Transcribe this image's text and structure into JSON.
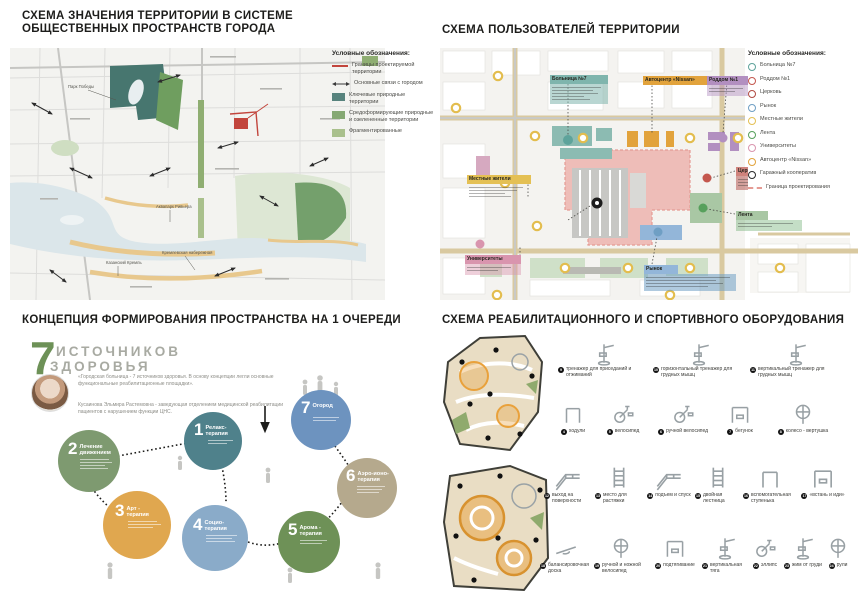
{
  "q1": {
    "title_line1": "СХЕМА ЗНАЧЕНИЯ ТЕРРИТОРИИ В СИСТЕМЕ",
    "title_line2": "ОБЩЕСТВЕННЫХ ПРОСТРАНСТВ ГОРОДА",
    "legend": {
      "title": "Условные обозначения:",
      "items": [
        {
          "label": "Границы проектируемой территории",
          "swatch": "red-line",
          "color": "#c2453c"
        },
        {
          "label": "Основные связи с городом",
          "swatch": "double-arrow",
          "color": "#3a3a3a"
        },
        {
          "label": "Ключевые природные территории",
          "swatch": "square",
          "color": "#57837d"
        },
        {
          "label": "Средоформирующие природные и озелененные территории",
          "swatch": "square",
          "color": "#85a873"
        },
        {
          "label": "Фрагментированные",
          "swatch": "square",
          "color": "#a9c08c"
        }
      ]
    },
    "map_labels": [
      "Парк Победы",
      "Аквапарк Ривьера",
      "Кремлевская набережная",
      "Казанский Кремль"
    ]
  },
  "q2": {
    "title": "СХЕМА ПОЛЬЗОВАТЕЛЕЙ ТЕРРИТОРИИ",
    "legend": {
      "title": "Условные обозначения:",
      "items": [
        {
          "label": "Больница №7",
          "color": "#5ea39b"
        },
        {
          "label": "Роддом №1",
          "color": "#c4574e"
        },
        {
          "label": "Церковь",
          "color": "#b04a42"
        },
        {
          "label": "Рынок",
          "color": "#6f9fc4"
        },
        {
          "label": "Местные жители",
          "color": "#e4c054"
        },
        {
          "label": "Лента",
          "color": "#57a05c"
        },
        {
          "label": "Университеты",
          "color": "#d995ae"
        },
        {
          "label": "Автоцентр «Nissan»",
          "color": "#e2a33c"
        },
        {
          "label": "Гаражный кооператив",
          "color": "#2b2b2b"
        },
        {
          "label": "Граница проектирования",
          "color": "#e59b94"
        }
      ]
    },
    "map_chips": [
      {
        "label": "Больница №7",
        "color": "#7fb5ad"
      },
      {
        "label": "Автоцентр «Nissan»",
        "color": "#e2a33c"
      },
      {
        "label": "Роддом №1",
        "color": "#b28fc0"
      },
      {
        "label": "Местные жители",
        "color": "#e4c054"
      },
      {
        "label": "Университеты",
        "color": "#d995ae"
      },
      {
        "label": "Рынок",
        "color": "#93b6d9"
      },
      {
        "label": "Церковь",
        "color": "#cf837c"
      },
      {
        "label": "Лента",
        "color": "#a9c7a4"
      }
    ]
  },
  "q3": {
    "title": "КОНЦЕПЦИЯ ФОРМИРОВАНИЯ ПРОСТРАНСТВА НА 1 ОЧЕРЕДИ",
    "heading_number": "7",
    "heading_word1": "ИСТОЧНИКОВ",
    "heading_word2": "ЗДОРОВЬЯ",
    "quote": "«Городская больница - 7 источников здоровья. В основу концепции легли основные функциональные реабилитационные площадки».",
    "attribution": "Кусаинова Эльмира Растемовна - заведующая отделением медицинской реабилитации пациентов с нарушением функции ЦНС.",
    "bubbles": [
      {
        "num": "1",
        "label": "Релакс-терапия",
        "color": "#4f818b"
      },
      {
        "num": "2",
        "label": "Лечение движением",
        "color": "#7e9a70"
      },
      {
        "num": "3",
        "label": "Арт - терапия",
        "color": "#e0a74f"
      },
      {
        "num": "4",
        "label": "Социо-терапия",
        "color": "#8aabc9"
      },
      {
        "num": "5",
        "label": "Арома - терапия",
        "color": "#6e9157"
      },
      {
        "num": "6",
        "label": "Аэро-ионо-терапия",
        "color": "#b5a98d"
      },
      {
        "num": "7",
        "label": "Огород",
        "color": "#6d93bf"
      }
    ]
  },
  "q4": {
    "title": "СХЕМА РЕАБИЛИТАЦИОННОГО И СПОРТИВНОГО ОБОРУДОВАНИЯ",
    "equipment": [
      {
        "num": "9",
        "label": "тренажер для приседаний и отжиманий"
      },
      {
        "num": "10",
        "label": "горизонтальный тренажер для грудных мышц"
      },
      {
        "num": "11",
        "label": "вертикальный тренажер для грудных мышц"
      },
      {
        "num": "4",
        "label": "ходули"
      },
      {
        "num": "5",
        "label": "велосипед"
      },
      {
        "num": "6",
        "label": "ручной велосипед"
      },
      {
        "num": "7",
        "label": "бегунок"
      },
      {
        "num": "8",
        "label": "колесо - вертушка"
      },
      {
        "num": "12",
        "label": "выход на поверхности"
      },
      {
        "num": "13",
        "label": "место для растяжки"
      },
      {
        "num": "14",
        "label": "подъем и спуск"
      },
      {
        "num": "15",
        "label": "двойная лестница"
      },
      {
        "num": "16",
        "label": "вспомогательная ступенька"
      },
      {
        "num": "17",
        "label": "«встань и иди»"
      },
      {
        "num": "18",
        "label": "балансировочная доска"
      },
      {
        "num": "19",
        "label": "ручной и ножной велосипед"
      },
      {
        "num": "20",
        "label": "подтягивание"
      },
      {
        "num": "21",
        "label": "вертикальная тяга"
      },
      {
        "num": "22",
        "label": "эллипс"
      },
      {
        "num": "23",
        "label": "жим от груди"
      },
      {
        "num": "24",
        "label": "рули"
      }
    ]
  }
}
